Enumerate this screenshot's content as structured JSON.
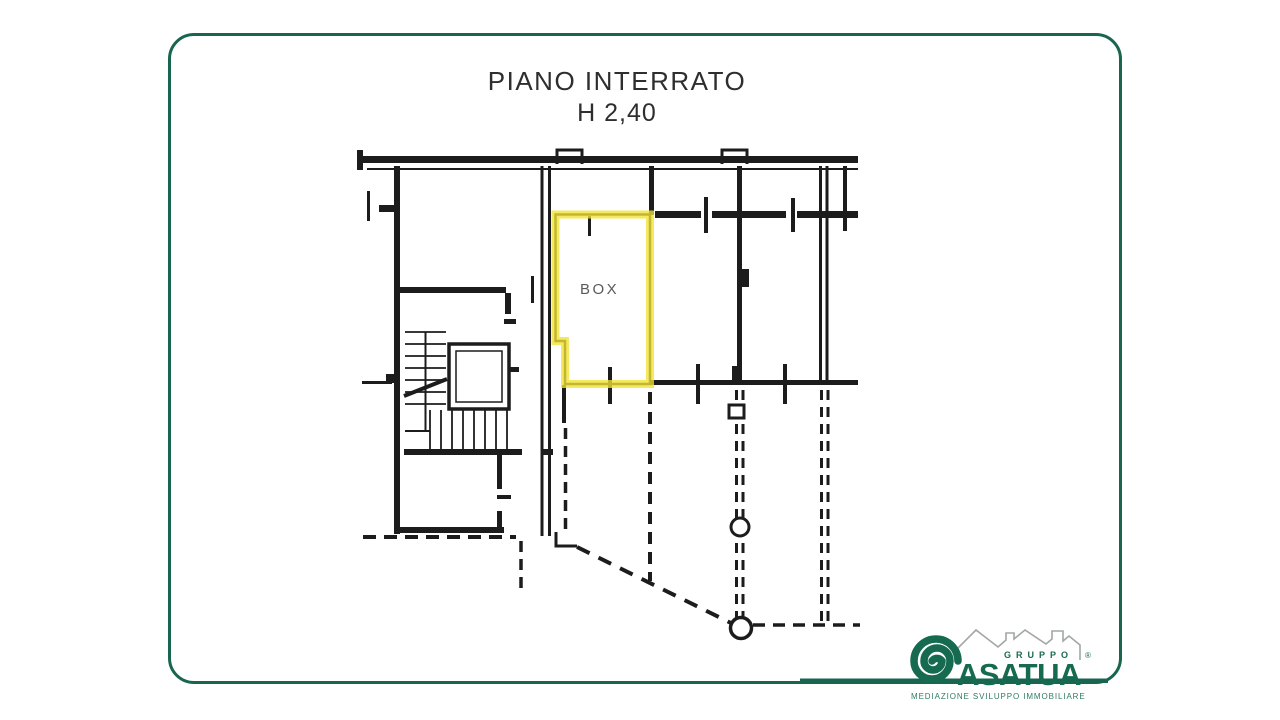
{
  "title": {
    "line1": "PIANO INTERRATO",
    "line2": "H 2,40"
  },
  "plan": {
    "room_label": "BOX",
    "highlight_color": "#f2e335",
    "line_color": "#1c1c1c"
  },
  "logo": {
    "group_label": "GRUPPO",
    "brand": "ASATUA",
    "registered": "®",
    "tagline": "MEDIAZIONE  SVILUPPO  IMMOBILIARE",
    "green": "#186650",
    "roof_gray": "#a2a7a5"
  },
  "frame": {
    "border_color": "#186650"
  }
}
